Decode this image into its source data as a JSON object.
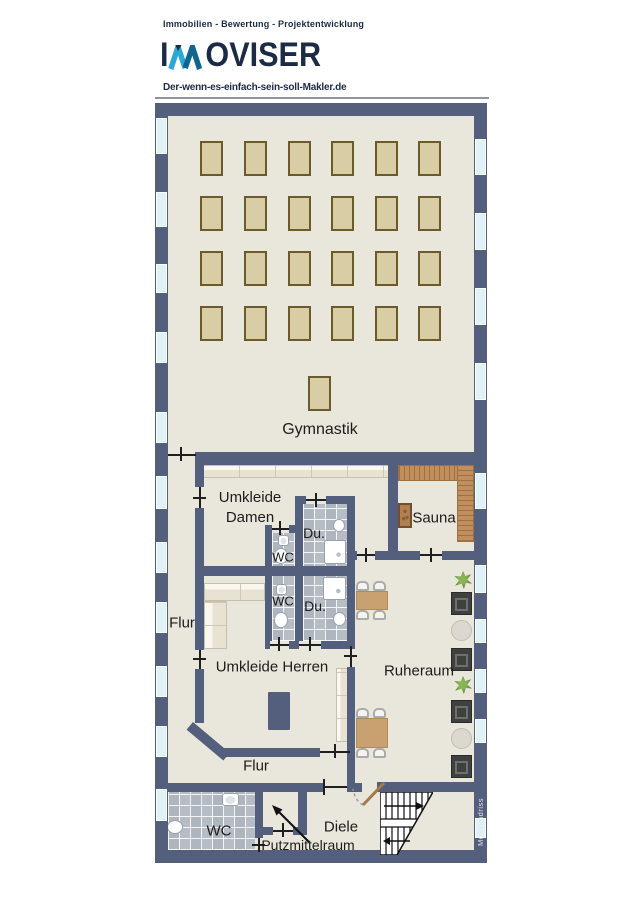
{
  "brand": {
    "tagline": "Immobilien - Bewertung - Projektentwicklung",
    "logo_prefix": "I",
    "logo_suffix": "OVISER",
    "url": "Der-wenn-es-einfach-sein-soll-Makler.de"
  },
  "plan": {
    "watermark": "McGrundriss",
    "colors": {
      "wall": "#545e7d",
      "floor": "#e9e6db",
      "glass": "#dff3f7",
      "tile": "#b6bdc5",
      "mat": "#d9cda6",
      "mat_border": "#6b5b2a",
      "sauna_wood": "#c18f5e",
      "sauna_wood_dark": "#9c7142",
      "table_wood": "#c9a171",
      "lounger": "#3f4040",
      "plant": "#4e7d2a",
      "label": "#1c1c1c",
      "navy": "#1b2b45",
      "logo_light": "#2aa8d6",
      "logo_dark": "#0f6790"
    },
    "rooms": {
      "gymnastik": {
        "label": "Gymnastik"
      },
      "umkleide_damen": {
        "label": "Umkleide Damen"
      },
      "du_oben": {
        "label": "Du."
      },
      "wc_oben": {
        "label": "WC"
      },
      "wc_mitte": {
        "label": "WC"
      },
      "du_mitte": {
        "label": "Du."
      },
      "sauna": {
        "label": "Sauna"
      },
      "flur_links": {
        "label": "Flur"
      },
      "umkleide_herren": {
        "label": "Umkleide Herren"
      },
      "ruheraum": {
        "label": "Ruheraum"
      },
      "flur_unten": {
        "label": "Flur"
      },
      "wc_unten": {
        "label": "WC"
      },
      "putzmittelraum": {
        "label": "Putzmittelraum"
      },
      "diele": {
        "label": "Diele"
      }
    },
    "gym_mats": {
      "cols_x": [
        200,
        244,
        288,
        331,
        375,
        418
      ],
      "rows_y": [
        141,
        196,
        251,
        306
      ],
      "w": 23,
      "h": 35,
      "extra": [
        {
          "x": 308,
          "y": 376
        }
      ]
    },
    "windows": {
      "left_x": 156,
      "right_x": 475,
      "w": 11,
      "left": [
        [
          118,
          36
        ],
        [
          192,
          35
        ],
        [
          264,
          29
        ],
        [
          332,
          31
        ],
        [
          412,
          31
        ],
        [
          476,
          33
        ],
        [
          542,
          31
        ],
        [
          602,
          31
        ],
        [
          666,
          31
        ],
        [
          726,
          31
        ],
        [
          789,
          32
        ]
      ],
      "right": [
        [
          139,
          36
        ],
        [
          213,
          37
        ],
        [
          288,
          37
        ],
        [
          363,
          37
        ],
        [
          473,
          36
        ],
        [
          565,
          28
        ],
        [
          619,
          24
        ],
        [
          669,
          24
        ],
        [
          719,
          24
        ],
        [
          818,
          20
        ]
      ]
    },
    "ruhe_items": [
      {
        "t": "plant",
        "y": 571
      },
      {
        "t": "lounger",
        "y": 592
      },
      {
        "t": "rtable",
        "y": 620
      },
      {
        "t": "lounger",
        "y": 648
      },
      {
        "t": "plant",
        "y": 676
      },
      {
        "t": "lounger",
        "y": 700
      },
      {
        "t": "rtable",
        "y": 728
      },
      {
        "t": "lounger",
        "y": 755
      }
    ]
  }
}
